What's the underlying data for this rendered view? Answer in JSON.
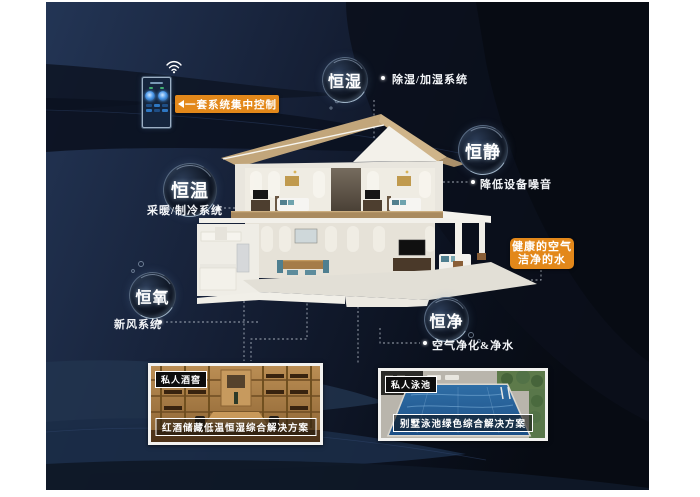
{
  "colors": {
    "accent_orange": "#e3881a",
    "background_navy": "#0c1322",
    "bubble_text": "#ffffff"
  },
  "control_panel": {
    "label": "一套系统集中控制"
  },
  "bubbles": {
    "humidity": {
      "label": "恒湿",
      "sub": "除湿/加湿系统"
    },
    "quiet": {
      "label": "恒静",
      "sub": "降低设备噪音"
    },
    "temperature": {
      "label": "恒温",
      "sub": "采暖/制冷系统"
    },
    "oxygen": {
      "label": "恒氧",
      "sub": "新风系统"
    },
    "purity": {
      "label": "恒净",
      "sub": "空气净化&净水"
    }
  },
  "callout": {
    "line1": "健康的空气",
    "line2": "洁净的水"
  },
  "photos": {
    "wine": {
      "tag": "私人酒窖",
      "caption": "红酒储藏低温恒湿综合解决方案"
    },
    "pool": {
      "tag": "私人泳池",
      "caption": "别墅泳池绿色综合解决方案"
    }
  }
}
